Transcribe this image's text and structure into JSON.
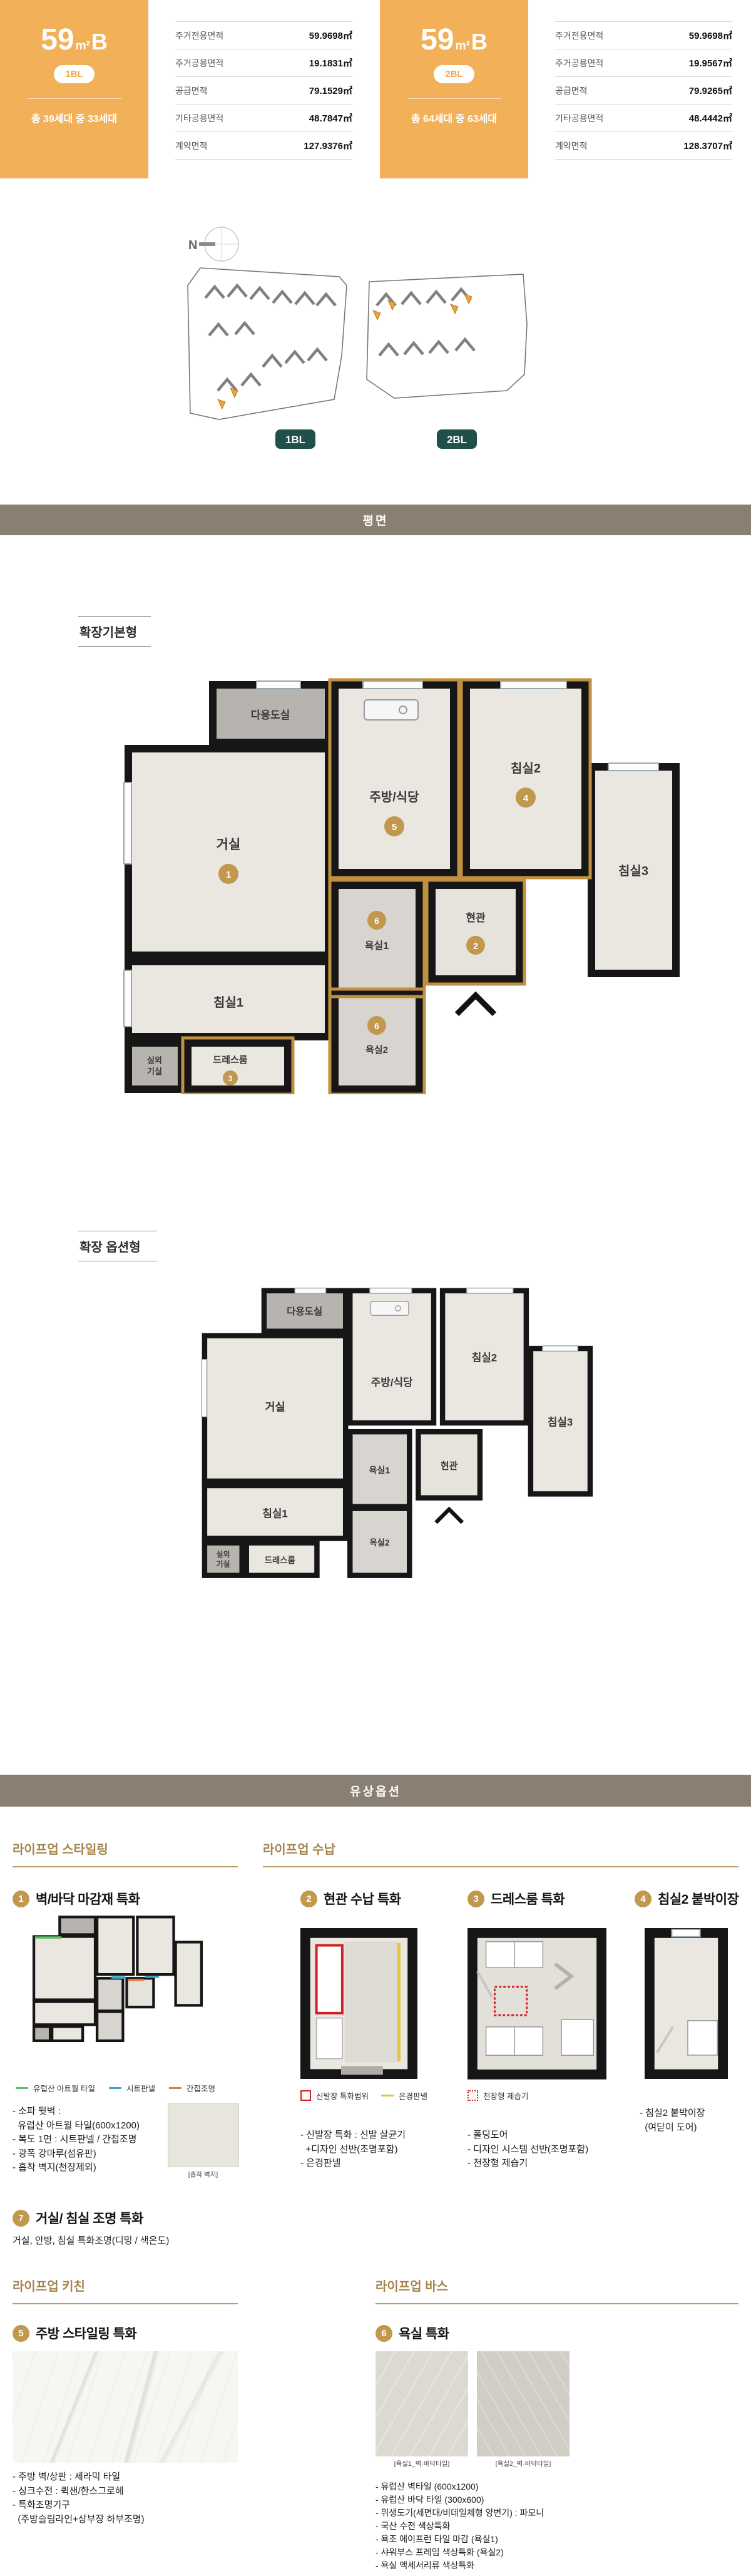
{
  "page": {
    "section_floor_plan": "평면",
    "section_paid_options": "유상옵션"
  },
  "units": [
    {
      "size_num": "59",
      "size_unit": "m²",
      "size_type": "B",
      "block": "1BL",
      "households": "총 39세대 중 33세대",
      "areas": [
        {
          "label": "주거전용면적",
          "value": "59.9698㎡"
        },
        {
          "label": "주거공용면적",
          "value": "19.1831㎡"
        },
        {
          "label": "공급면적",
          "value": "79.1529㎡"
        },
        {
          "label": "기타공용면적",
          "value": "48.7847㎡"
        },
        {
          "label": "계약면적",
          "value": "127.9376㎡"
        }
      ]
    },
    {
      "size_num": "59",
      "size_unit": "m²",
      "size_type": "B",
      "block": "2BL",
      "households": "총 64세대 중 63세대",
      "areas": [
        {
          "label": "주거전용면적",
          "value": "59.9698㎡"
        },
        {
          "label": "주거공용면적",
          "value": "19.9567㎡"
        },
        {
          "label": "공급면적",
          "value": "79.9265㎡"
        },
        {
          "label": "기타공용면적",
          "value": "48.4442㎡"
        },
        {
          "label": "계약면적",
          "value": "128.3707㎡"
        }
      ]
    }
  ],
  "site_plan": {
    "compass_label": "N",
    "block1_label": "1BL",
    "block2_label": "2BL"
  },
  "plans": {
    "basic_title": "확장기본형",
    "option_title": "확장 옵션형"
  },
  "rooms": {
    "utility": "다용도실",
    "living": "거실",
    "kitchen": "주방/식당",
    "bed2": "침실2",
    "bed3": "침실3",
    "bath1": "욕실1",
    "entrance": "현관",
    "bed1": "침실1",
    "dress": "드레스룸",
    "bath2": "욕실2",
    "outdoor_l1": "실외",
    "outdoor_l2": "기실"
  },
  "plan_numbers": {
    "living": "1",
    "entrance": "2",
    "dress": "3",
    "bed2": "4",
    "kitchen": "5",
    "bath": "6"
  },
  "options": {
    "styling": {
      "title": "라이프업 스타일링",
      "item1": {
        "num": "1",
        "title": "벽/바닥 마감재 특화",
        "legend": [
          {
            "label": "유럽산 아트월 타일"
          },
          {
            "label": "시트판넬"
          },
          {
            "label": "간접조명"
          }
        ],
        "bullets": [
          "- 소파 뒷벽 :",
          "  유럽산 아트월 타일(600x1200)",
          "- 복도 1면 : 시트판넬 / 간접조명",
          "- 광폭 강마루(섬유판)",
          "- 흡착 벽지(천장제외)"
        ],
        "swatch_caption": "[흡착 벽지]"
      },
      "item7": {
        "num": "7",
        "title": "거실/ 침실 조명 특화",
        "desc": "거실, 안방, 침실 특화조명(디밍 / 색온도)"
      }
    },
    "storage": {
      "title": "라이프업 수납",
      "item2": {
        "num": "2",
        "title": "현관 수납 특화",
        "legend1": "신발장 특화범위",
        "legend2": "은경판넬",
        "bullets": [
          "- 신발장 특화 : 신발 살균기",
          "  +디자인 선반(조명포함)",
          "- 은경판넬"
        ]
      },
      "item3": {
        "num": "3",
        "title": "드레스룸 특화",
        "legend1": "천장형 제습기",
        "bullets": [
          "- 폴딩도어",
          "- 디자인 시스템 선반(조명포함)",
          "- 천장형 제습기"
        ]
      },
      "item4": {
        "num": "4",
        "title": "침실2 붙박이장",
        "bullets": [
          "- 침실2 붙박이장",
          "  (여닫이 도어)"
        ]
      }
    },
    "kitchen": {
      "title": "라이프업 키친",
      "item5": {
        "num": "5",
        "title": "주방 스타일링 특화",
        "bullets": [
          "- 주방 벽/상판 : 세라믹 타일",
          "- 싱크수전 : 퀵샌/한스그로헤",
          "- 특화조명기구",
          "  (주방슬림라인+상부장 하부조명)"
        ]
      }
    },
    "bath": {
      "title": "라이프업 바스",
      "item6": {
        "num": "6",
        "title": "욕실 특화",
        "caption1": "[욕실1_벽·바닥타일]",
        "caption2": "[욕실2_벽·바닥타일]",
        "bullets": [
          "- 유럽산 벽타일 (600x1200)",
          "- 유럽산 바닥 타일 (300x600)",
          "- 위생도기(세면대/비데일체형 양변기) : 파모니",
          "- 국산 수전 색상특화",
          "- 욕조 에이프런 타일 마감 (욕실1)",
          "- 샤워부스 프레임 색상특화 (욕실2)",
          "- 욕실 액세서리류 색상특화"
        ]
      }
    },
    "colors": {
      "accent_orange": "#f2b159",
      "bar_brown": "#8a7f73",
      "gold": "#c2974e",
      "teal_badge": "#21504c",
      "legend_green": "#5fbf63",
      "legend_blue": "#3e9fd0",
      "legend_orange": "#e0783f",
      "legend_red": "#d21f26",
      "legend_yellow": "#e6c243"
    }
  }
}
